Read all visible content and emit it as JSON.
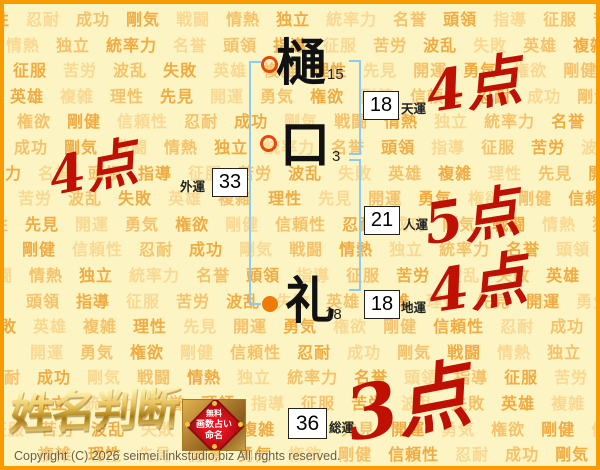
{
  "background": {
    "words": [
      "信頼性",
      "忍耐",
      "成功",
      "剛気",
      "戦闘",
      "情熱",
      "独立",
      "統率力",
      "名誉",
      "頭領",
      "指導",
      "征服",
      "苦労",
      "波乱",
      "失敗",
      "英雄",
      "複雑",
      "理性",
      "先見",
      "開運",
      "勇気",
      "権欲",
      "剛健"
    ],
    "word_colors": [
      "#f0ab43",
      "#f5c26b",
      "#f9d892"
    ]
  },
  "name": {
    "characters": [
      {
        "char": "樋",
        "strokes": "15",
        "part": "surname"
      },
      {
        "char": "口",
        "strokes": "3",
        "part": "surname"
      },
      {
        "char": "礼",
        "strokes": "18",
        "part": "given"
      }
    ]
  },
  "fortunes": {
    "heaven": {
      "label": "天運",
      "value": "18",
      "score": "4点"
    },
    "outer": {
      "label": "外運",
      "value": "33",
      "score": "4点"
    },
    "person": {
      "label": "人運",
      "value": "21",
      "score": "5点"
    },
    "earth": {
      "label": "地運",
      "value": "18",
      "score": "4点"
    },
    "total": {
      "label": "総運",
      "value": "36",
      "score": "3点"
    }
  },
  "logo": {
    "title": "姓名判断",
    "badge": {
      "line1": "無料",
      "line2": "画数占い",
      "line3": "命名"
    }
  },
  "footer": {
    "copyright": "Copyright (C) 2026 seimei.linkstudio.biz All rights reserved."
  },
  "colors": {
    "score_red": "#bf1103",
    "bracket_blue": "#8ccaf3",
    "border_orange": "#f89b00",
    "surname_marker_ring": "#e8470c",
    "given_marker_dot": "#ee7c04",
    "background_yellow": "#fcf5c3"
  }
}
